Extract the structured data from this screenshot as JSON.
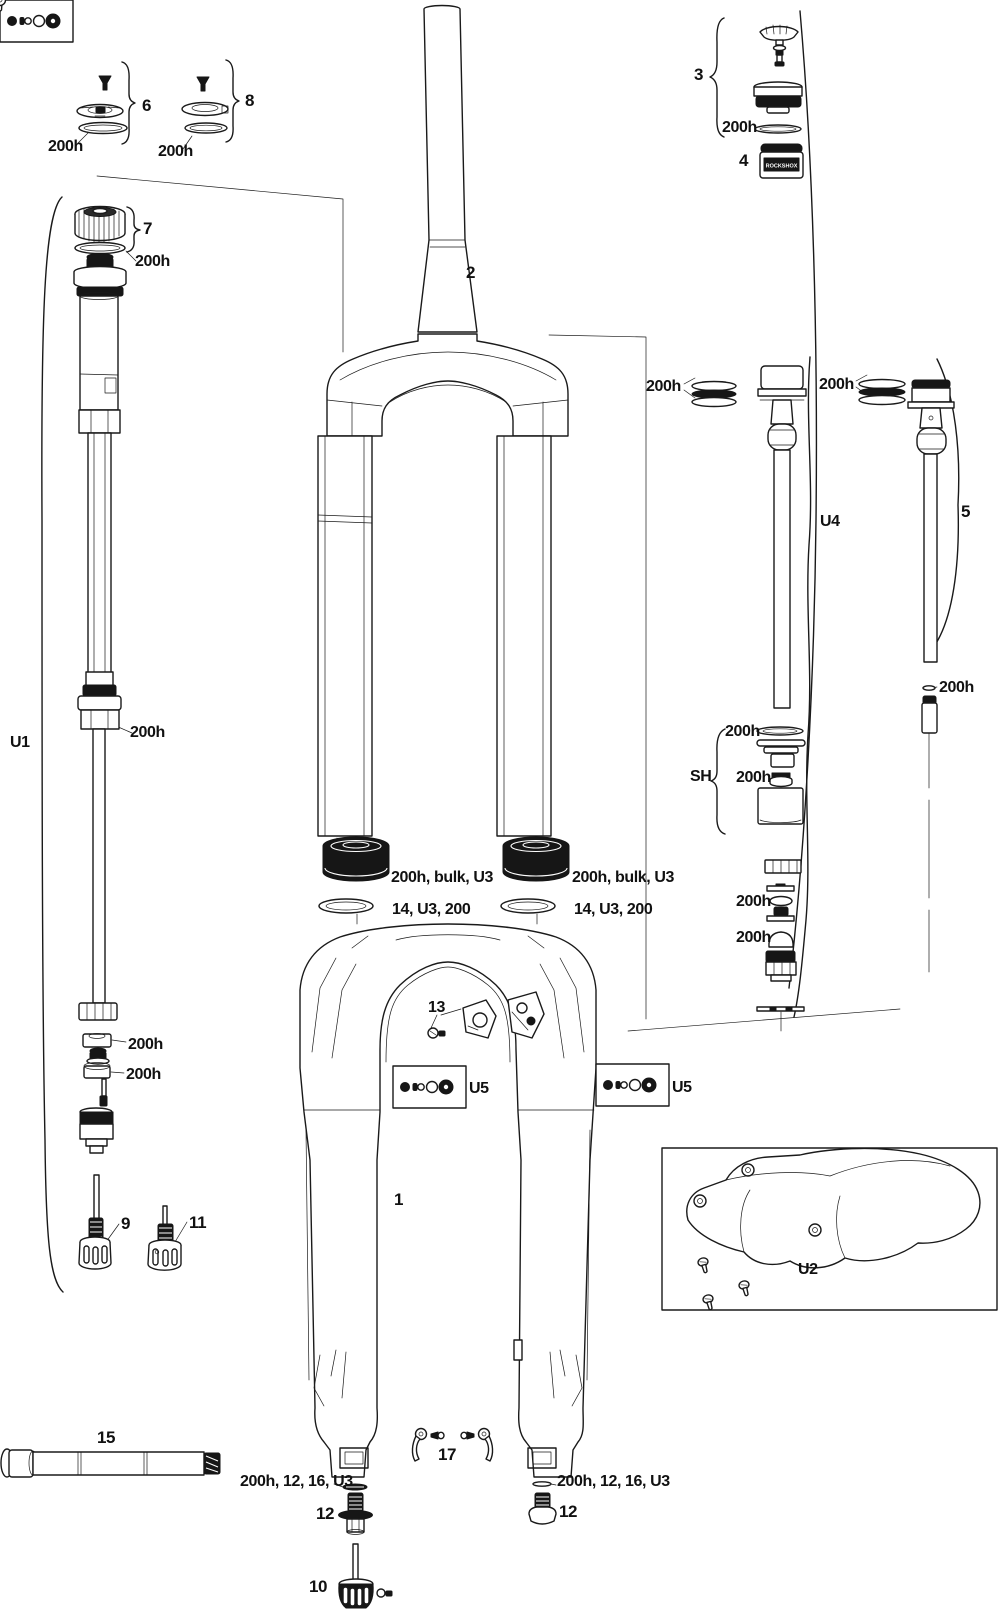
{
  "diagram": {
    "background": "#ffffff",
    "ink": "#1a1a1a",
    "token_text": "ROCKSHOX",
    "labels": [
      {
        "id": "part-6",
        "text": "6",
        "x": 142,
        "y": 97,
        "fs": 17
      },
      {
        "id": "part-8",
        "text": "8",
        "x": 245,
        "y": 92,
        "fs": 17
      },
      {
        "id": "oring-part6",
        "text": "200h",
        "x": 48,
        "y": 139,
        "fs": 16
      },
      {
        "id": "oring-part8",
        "text": "200h",
        "x": 158,
        "y": 144,
        "fs": 16
      },
      {
        "id": "part-7",
        "text": "7",
        "x": 143,
        "y": 220,
        "fs": 17
      },
      {
        "id": "oring-part7",
        "text": "200h",
        "x": 135,
        "y": 254,
        "fs": 16
      },
      {
        "id": "group-u1",
        "text": "U1",
        "x": 10,
        "y": 735,
        "fs": 16
      },
      {
        "id": "oring-damper",
        "text": "200h",
        "x": 130,
        "y": 725,
        "fs": 16
      },
      {
        "id": "oring-cup",
        "text": "200h",
        "x": 128,
        "y": 1037,
        "fs": 16
      },
      {
        "id": "oring-ring",
        "text": "200h",
        "x": 126,
        "y": 1067,
        "fs": 16
      },
      {
        "id": "part-9",
        "text": "9",
        "x": 121,
        "y": 1215,
        "fs": 17
      },
      {
        "id": "part-11",
        "text": "11",
        "x": 189,
        "y": 1214,
        "fs": 17
      },
      {
        "id": "part-15",
        "text": "15",
        "x": 97,
        "y": 1429,
        "fs": 17
      },
      {
        "id": "part-2",
        "text": "2",
        "x": 466,
        "y": 264,
        "fs": 17
      },
      {
        "id": "seal-left",
        "text": "200h, bulk, U3",
        "x": 391,
        "y": 870,
        "fs": 16
      },
      {
        "id": "foam-left",
        "text": "14, U3, 200",
        "x": 392,
        "y": 902,
        "fs": 16
      },
      {
        "id": "seal-right",
        "text": "200h, bulk, U3",
        "x": 572,
        "y": 870,
        "fs": 16
      },
      {
        "id": "foam-right",
        "text": "14, U3, 200",
        "x": 574,
        "y": 902,
        "fs": 16
      },
      {
        "id": "part-13",
        "text": "13",
        "x": 428,
        "y": 1000,
        "fs": 16
      },
      {
        "id": "kit-u5-left",
        "text": "U5",
        "x": 469,
        "y": 1081,
        "fs": 16
      },
      {
        "id": "kit-u5-right",
        "text": "U5",
        "x": 672,
        "y": 1080,
        "fs": 16
      },
      {
        "id": "part-1",
        "text": "1",
        "x": 394,
        "y": 1191,
        "fs": 17
      },
      {
        "id": "part-3",
        "text": "3",
        "x": 694,
        "y": 66,
        "fs": 17
      },
      {
        "id": "oring-part3",
        "text": "200h",
        "x": 722,
        "y": 120,
        "fs": 16
      },
      {
        "id": "part-4",
        "text": "4",
        "x": 739,
        "y": 152,
        "fs": 17
      },
      {
        "id": "seals-u4",
        "text": "200h",
        "x": 646,
        "y": 379,
        "fs": 16
      },
      {
        "id": "seals-5",
        "text": "200h",
        "x": 819,
        "y": 377,
        "fs": 16
      },
      {
        "id": "group-u4",
        "text": "U4",
        "x": 820,
        "y": 514,
        "fs": 16
      },
      {
        "id": "part-5",
        "text": "5",
        "x": 961,
        "y": 503,
        "fs": 17
      },
      {
        "id": "oring-shaft",
        "text": "200h",
        "x": 939,
        "y": 680,
        "fs": 16
      },
      {
        "id": "oring-sh-1",
        "text": "200h",
        "x": 725,
        "y": 724,
        "fs": 16
      },
      {
        "id": "group-sh",
        "text": "SH",
        "x": 690,
        "y": 769,
        "fs": 16
      },
      {
        "id": "oring-sh-2",
        "text": "200h",
        "x": 736,
        "y": 770,
        "fs": 16
      },
      {
        "id": "oring-sh-3",
        "text": "200h",
        "x": 736,
        "y": 894,
        "fs": 16
      },
      {
        "id": "oring-sh-4",
        "text": "200h",
        "x": 736,
        "y": 930,
        "fs": 16
      },
      {
        "id": "kit-u2",
        "text": "U2",
        "x": 798,
        "y": 1262,
        "fs": 16
      },
      {
        "id": "part-17",
        "text": "17",
        "x": 438,
        "y": 1446,
        "fs": 17
      },
      {
        "id": "washer-left",
        "text": "200h, 12, 16, U3",
        "x": 240,
        "y": 1474,
        "fs": 16
      },
      {
        "id": "washer-right",
        "text": "200h, 12, 16, U3",
        "x": 557,
        "y": 1474,
        "fs": 16
      },
      {
        "id": "part-12-left",
        "text": "12",
        "x": 316,
        "y": 1505,
        "fs": 17
      },
      {
        "id": "part-12-right",
        "text": "12",
        "x": 559,
        "y": 1503,
        "fs": 17
      },
      {
        "id": "part-10",
        "text": "10",
        "x": 309,
        "y": 1578,
        "fs": 17
      }
    ]
  }
}
